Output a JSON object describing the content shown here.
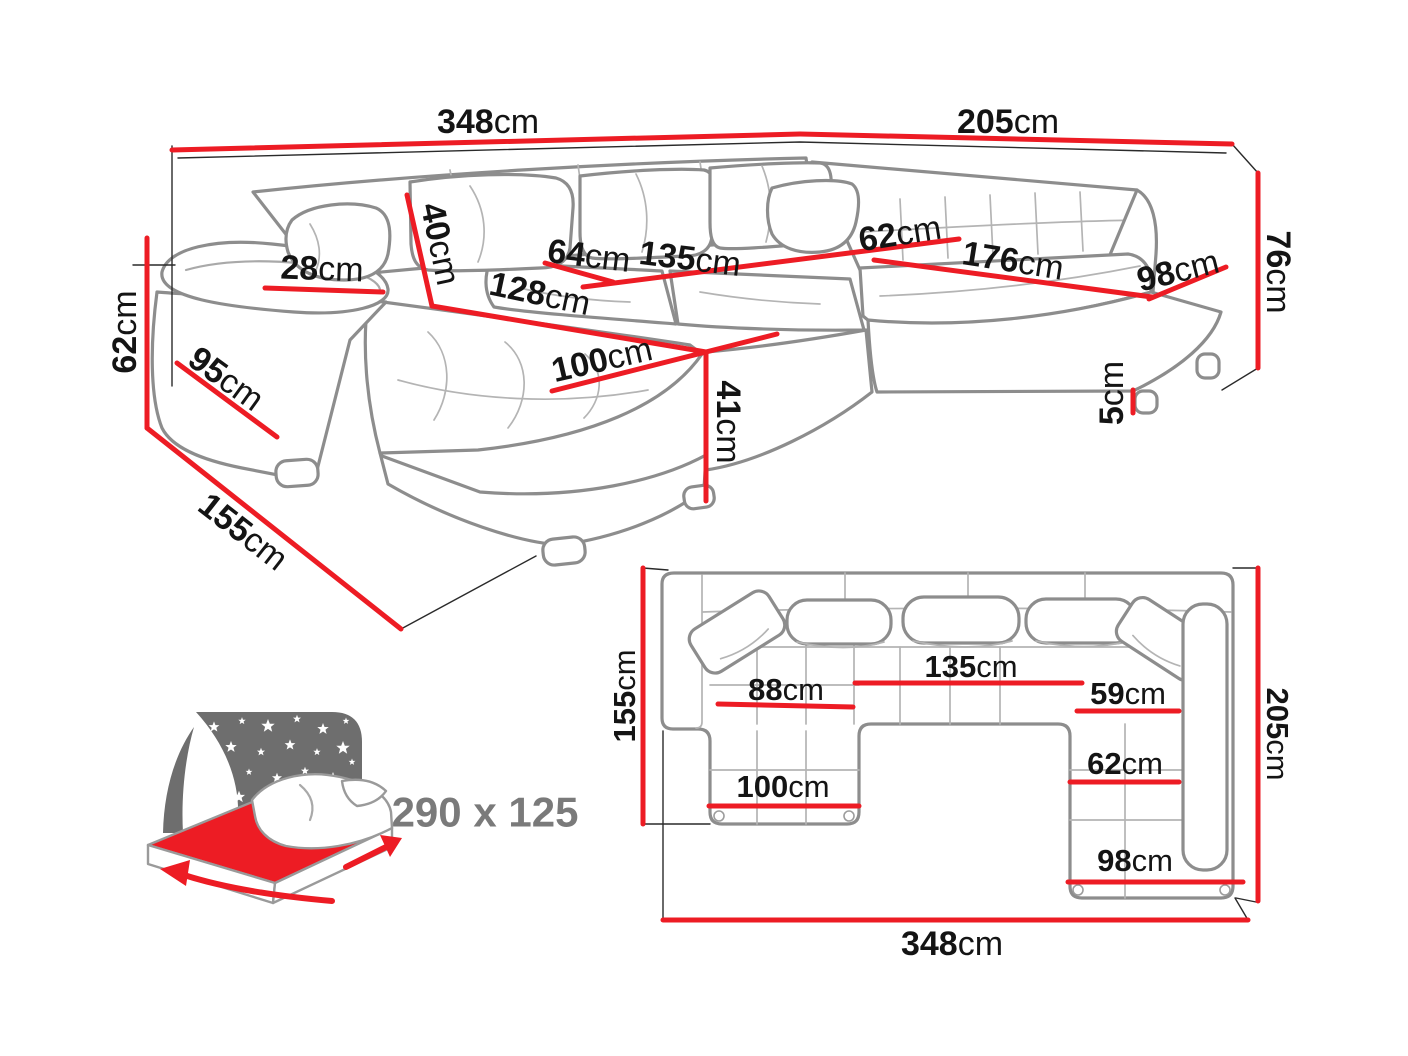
{
  "colors": {
    "dimension_red": "#ed1c24",
    "outline_gray": "#8d8d8d",
    "text_black": "#141414",
    "icon_gray": "#6e6e6e",
    "bed_text_gray": "#7a7a7a"
  },
  "perspective": {
    "labels": {
      "total_width": {
        "value": "348",
        "unit": "cm"
      },
      "right_side_width": {
        "value": "205",
        "unit": "cm"
      },
      "back_height": {
        "value": "76",
        "unit": "cm"
      },
      "arm_height": {
        "value": "62",
        "unit": "cm"
      },
      "chaise_total_depth": {
        "value": "155",
        "unit": "cm"
      },
      "arm_front_depth": {
        "value": "95",
        "unit": "cm"
      },
      "arm_width": {
        "value": "28",
        "unit": "cm"
      },
      "back_cushion_height": {
        "value": "40",
        "unit": "cm"
      },
      "seat_depth": {
        "value": "64",
        "unit": "cm"
      },
      "middle_seat_width": {
        "value": "135",
        "unit": "cm"
      },
      "chaise_seat_length": {
        "value": "128",
        "unit": "cm"
      },
      "chaise_width": {
        "value": "100",
        "unit": "cm"
      },
      "seat_height": {
        "value": "41",
        "unit": "cm"
      },
      "right_seat_depth": {
        "value": "62",
        "unit": "cm"
      },
      "right_seat_length": {
        "value": "176",
        "unit": "cm"
      },
      "right_section_depth": {
        "value": "98",
        "unit": "cm"
      },
      "leg_height": {
        "value": "5",
        "unit": "cm"
      }
    }
  },
  "top_view": {
    "labels": {
      "chaise_depth": {
        "value": "155",
        "unit": "cm"
      },
      "right_section_depth": {
        "value": "205",
        "unit": "cm"
      },
      "left_seat_width": {
        "value": "88",
        "unit": "cm"
      },
      "middle_seat_width": {
        "value": "135",
        "unit": "cm"
      },
      "right_seat_upper_depth": {
        "value": "59",
        "unit": "cm"
      },
      "right_seat_lower_depth": {
        "value": "62",
        "unit": "cm"
      },
      "chaise_width": {
        "value": "100",
        "unit": "cm"
      },
      "right_section_width": {
        "value": "98",
        "unit": "cm"
      },
      "total_width": {
        "value": "348",
        "unit": "cm"
      }
    }
  },
  "sleeping_function": {
    "bed_size": "290 x 125"
  }
}
